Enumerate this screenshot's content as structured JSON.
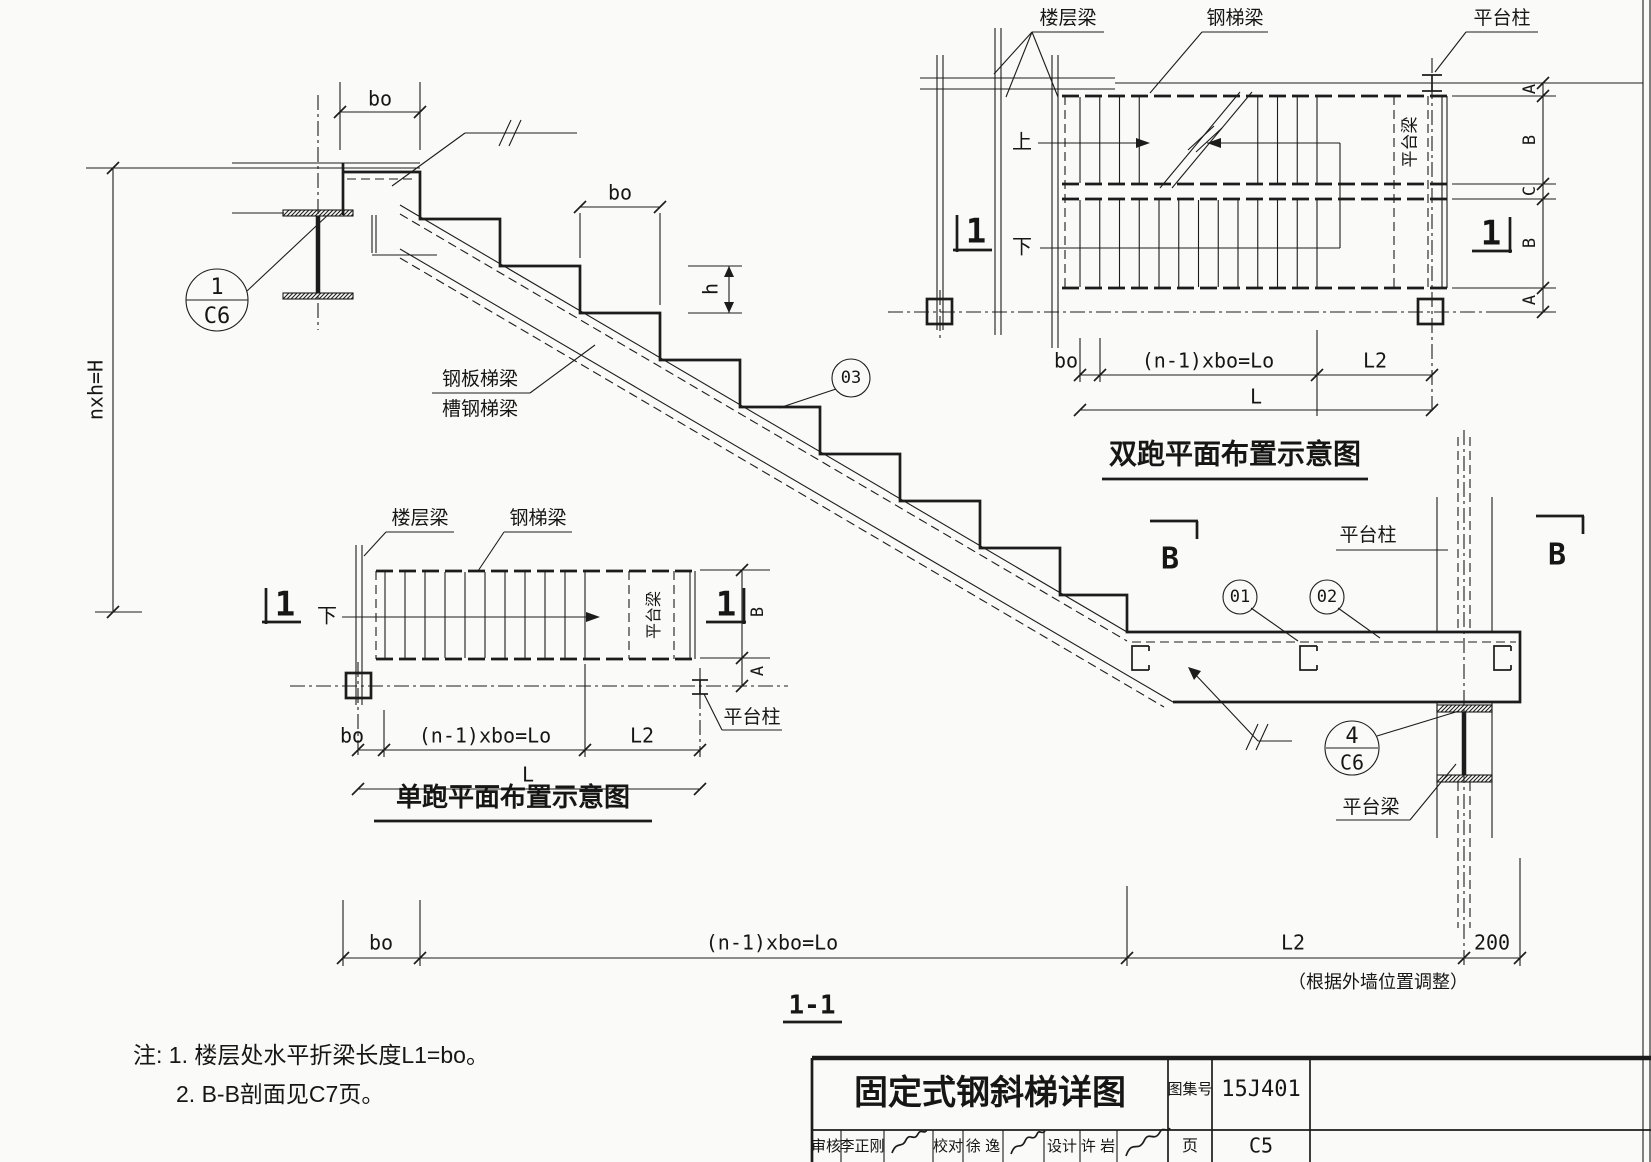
{
  "colors": {
    "ink": "#1c1c1c",
    "paper": "#fafaf8"
  },
  "section_1_1": {
    "title": "1-1",
    "dims": {
      "bo_top": "bo",
      "bo_mid": "bo",
      "h": "h",
      "nxh": "nxh=H",
      "bottom_bo": "bo",
      "bottom_lo": "(n-1)xbo=Lo",
      "bottom_l2": "L2",
      "bottom_200": "200",
      "wall_note": "（根据外墙位置调整）"
    },
    "callouts": {
      "c1_num": "1",
      "c1_page": "C6",
      "c03": "03",
      "c01": "01",
      "c02": "02",
      "c4_num": "4",
      "c4_page": "C6"
    },
    "labels": {
      "plate_stringer": "钢板梯梁",
      "channel_stringer": "槽钢梯梁",
      "platform_column": "平台柱",
      "platform_beam": "平台梁",
      "section_b": "B"
    }
  },
  "double_run_plan": {
    "title": "双跑平面布置示意图",
    "labels": {
      "floor_beam": "楼层梁",
      "stair_beam": "钢梯梁",
      "platform_column": "平台柱",
      "platform_beam": "平台梁",
      "up": "上",
      "down": "下"
    },
    "marker": "1",
    "dims": {
      "bo": "bo",
      "lo": "(n-1)xbo=Lo",
      "l2": "L2",
      "l": "L",
      "chain": [
        "A",
        "B",
        "C",
        "B",
        "A"
      ]
    }
  },
  "single_run_plan": {
    "title": "单跑平面布置示意图",
    "labels": {
      "floor_beam": "楼层梁",
      "stair_beam": "钢梯梁",
      "platform_column": "平台柱",
      "platform_beam": "平台梁",
      "down": "下"
    },
    "marker": "1",
    "dims": {
      "bo": "bo",
      "lo": "(n-1)xbo=Lo",
      "l2": "L2",
      "l": "L",
      "chain_b": "B",
      "chain_a": "A"
    }
  },
  "notes": {
    "line1": "注: 1. 楼层处水平折梁长度L1=bo。",
    "line2": "2. B-B剖面见C7页。"
  },
  "title_block": {
    "drawing_title": "固定式钢斜梯详图",
    "atlas_label": "图集号",
    "atlas_no": "15J401",
    "page_label": "页",
    "page_no": "C5",
    "reviewer_label": "审核",
    "reviewer": "李正刚",
    "checker_label": "校对",
    "checker": "徐 逸",
    "designer_label": "设计",
    "designer": "许 岩"
  }
}
